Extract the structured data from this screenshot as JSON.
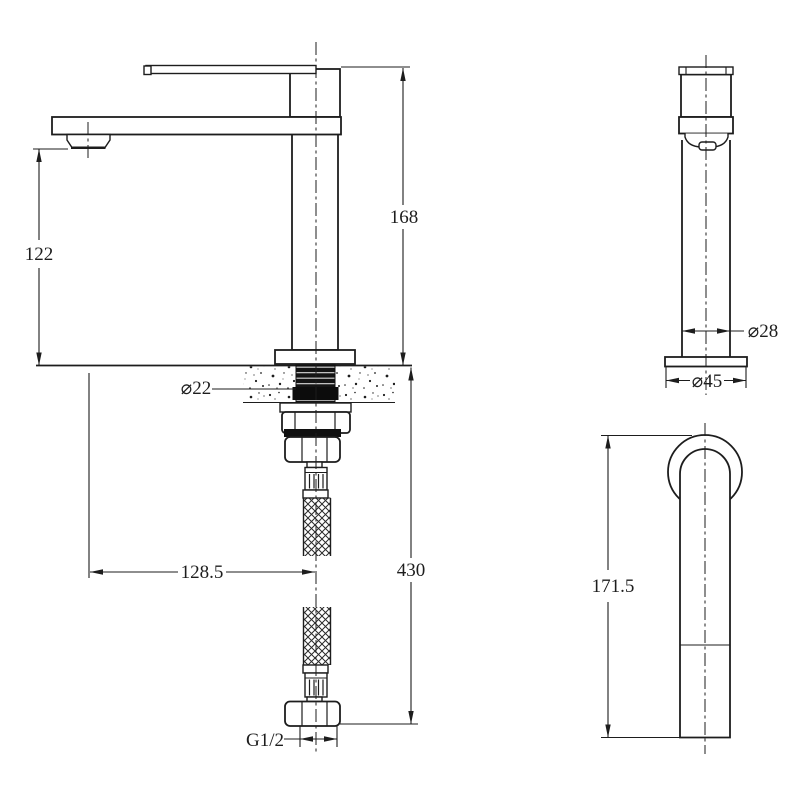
{
  "drawing": {
    "type": "technical-dimension-drawing",
    "subject": "basin mixer tap with flexible supply hose",
    "colors": {
      "line": "#1d1d1d",
      "background": "#ffffff"
    },
    "side_view": {
      "spout_height": "122",
      "total_height": "168",
      "thread_diameter": "⌀22",
      "spout_reach": "128.5",
      "hose_length": "430",
      "connection_thread": "G1/2"
    },
    "front_view": {
      "body_diameter": "⌀28",
      "base_diameter": "⌀45"
    },
    "top_view": {
      "overall_length": "171.5"
    }
  }
}
